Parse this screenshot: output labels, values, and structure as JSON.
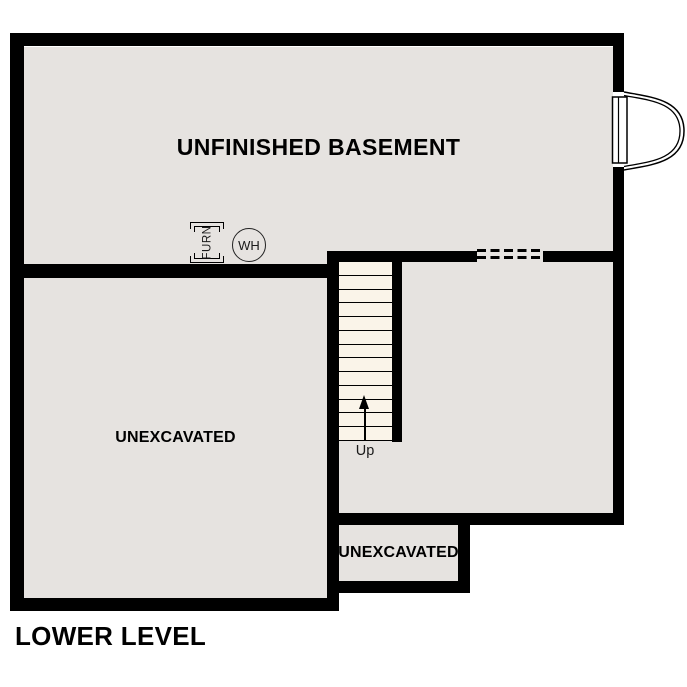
{
  "page_title": "LOWER LEVEL",
  "rooms": {
    "basement": {
      "label": "UNFINISHED BASEMENT"
    },
    "unexcavated_left": {
      "label": "UNEXCAVATED"
    },
    "unexcavated_small": {
      "label": "UNEXCAVATED"
    }
  },
  "stairs": {
    "label": "Up",
    "tread_count": 13
  },
  "symbols": {
    "furnace": {
      "label": "FURN"
    },
    "water_heater": {
      "label": "WH"
    }
  },
  "colors": {
    "wall": "#000000",
    "room_fill": "#e6e3e0",
    "stair_fill": "#faf4e9",
    "background": "#ffffff",
    "text": "#000000"
  }
}
